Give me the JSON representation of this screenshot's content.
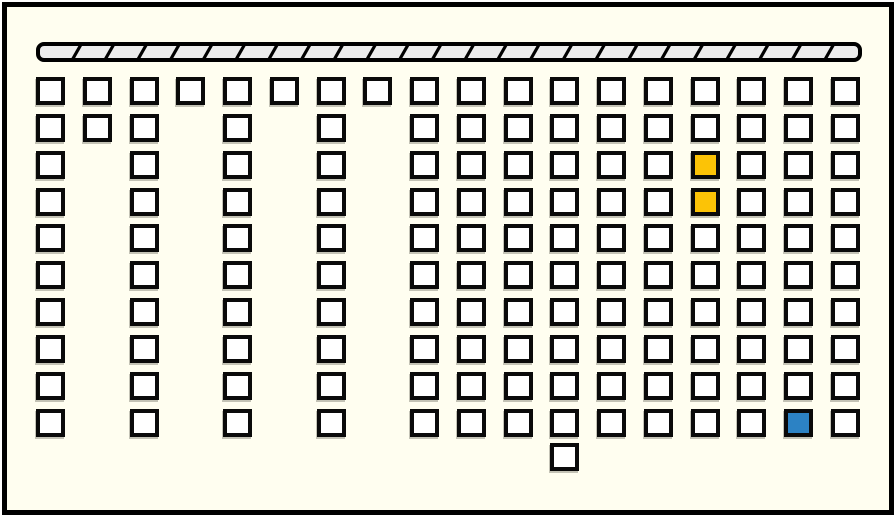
{
  "scene": {
    "description": "Seating plan floor diagram with hatched front wall bar, grid of seat squares, two yellow-selected seats, one blue-selected seat and one detached seat",
    "canvas_width": 896,
    "canvas_height": 517
  },
  "colors": {
    "page_background": "#ffffff",
    "board_background": "#fffef0",
    "frame_border": "#000000",
    "seat_fill": "#ffffff",
    "seat_border": "#0a0a0a",
    "seat_selected_yellow": "#fcc306",
    "seat_selected_blue": "#2c82c4",
    "front_bar_fill": "#ececec",
    "front_bar_stroke": "#000000"
  },
  "front_bar": {
    "x": 36,
    "y": 42,
    "width": 826,
    "height": 20,
    "segments": 25,
    "slant": 8,
    "corner_radius": 6,
    "outline_width": 4,
    "divider_width": 3.2
  },
  "seat_grid": {
    "origin_x": 36,
    "origin_y": 77,
    "col_spacing": 46.75,
    "row_spacing": 36.85,
    "seat_width": 29,
    "seat_height": 28,
    "columns": [
      {
        "rows": [
          0,
          1,
          2,
          3,
          4,
          5,
          6,
          7,
          8,
          9
        ]
      },
      {
        "rows": [
          0,
          1
        ]
      },
      {
        "rows": [
          0,
          1,
          2,
          3,
          4,
          5,
          6,
          7,
          8,
          9
        ]
      },
      {
        "rows": [
          0
        ]
      },
      {
        "rows": [
          0,
          1,
          2,
          3,
          4,
          5,
          6,
          7,
          8,
          9
        ]
      },
      {
        "rows": [
          0
        ]
      },
      {
        "rows": [
          0,
          1,
          2,
          3,
          4,
          5,
          6,
          7,
          8,
          9
        ]
      },
      {
        "rows": [
          0
        ]
      },
      {
        "rows": [
          0,
          1,
          2,
          3,
          4,
          5,
          6,
          7,
          8,
          9
        ]
      },
      {
        "rows": [
          0,
          1,
          2,
          3,
          4,
          5,
          6,
          7,
          8,
          9
        ]
      },
      {
        "rows": [
          0,
          1,
          2,
          3,
          4,
          5,
          6,
          7,
          8,
          9
        ]
      },
      {
        "rows": [
          0,
          1,
          2,
          3,
          4,
          5,
          6,
          7,
          8,
          9
        ]
      },
      {
        "rows": [
          0,
          1,
          2,
          3,
          4,
          5,
          6,
          7,
          8,
          9
        ]
      },
      {
        "rows": [
          0,
          1,
          2,
          3,
          4,
          5,
          6,
          7,
          8,
          9
        ]
      },
      {
        "rows": [
          0,
          1,
          2,
          3,
          4,
          5,
          6,
          7,
          8,
          9
        ]
      },
      {
        "rows": [
          0,
          1,
          2,
          3,
          4,
          5,
          6,
          7,
          8,
          9
        ]
      },
      {
        "rows": [
          0,
          1,
          2,
          3,
          4,
          5,
          6,
          7,
          8,
          9
        ]
      },
      {
        "rows": [
          0,
          1,
          2,
          3,
          4,
          5,
          6,
          7,
          8,
          9
        ]
      }
    ],
    "highlighted_seats": [
      {
        "col": 14,
        "row": 2,
        "state": "selected-yellow"
      },
      {
        "col": 14,
        "row": 3,
        "state": "selected-yellow"
      },
      {
        "col": 16,
        "row": 9,
        "state": "selected-blue"
      }
    ],
    "detached_seat": {
      "x": 550,
      "y": 443
    }
  },
  "counts": {
    "total_seats": 146,
    "yellow_selected": 2,
    "blue_selected": 1
  }
}
